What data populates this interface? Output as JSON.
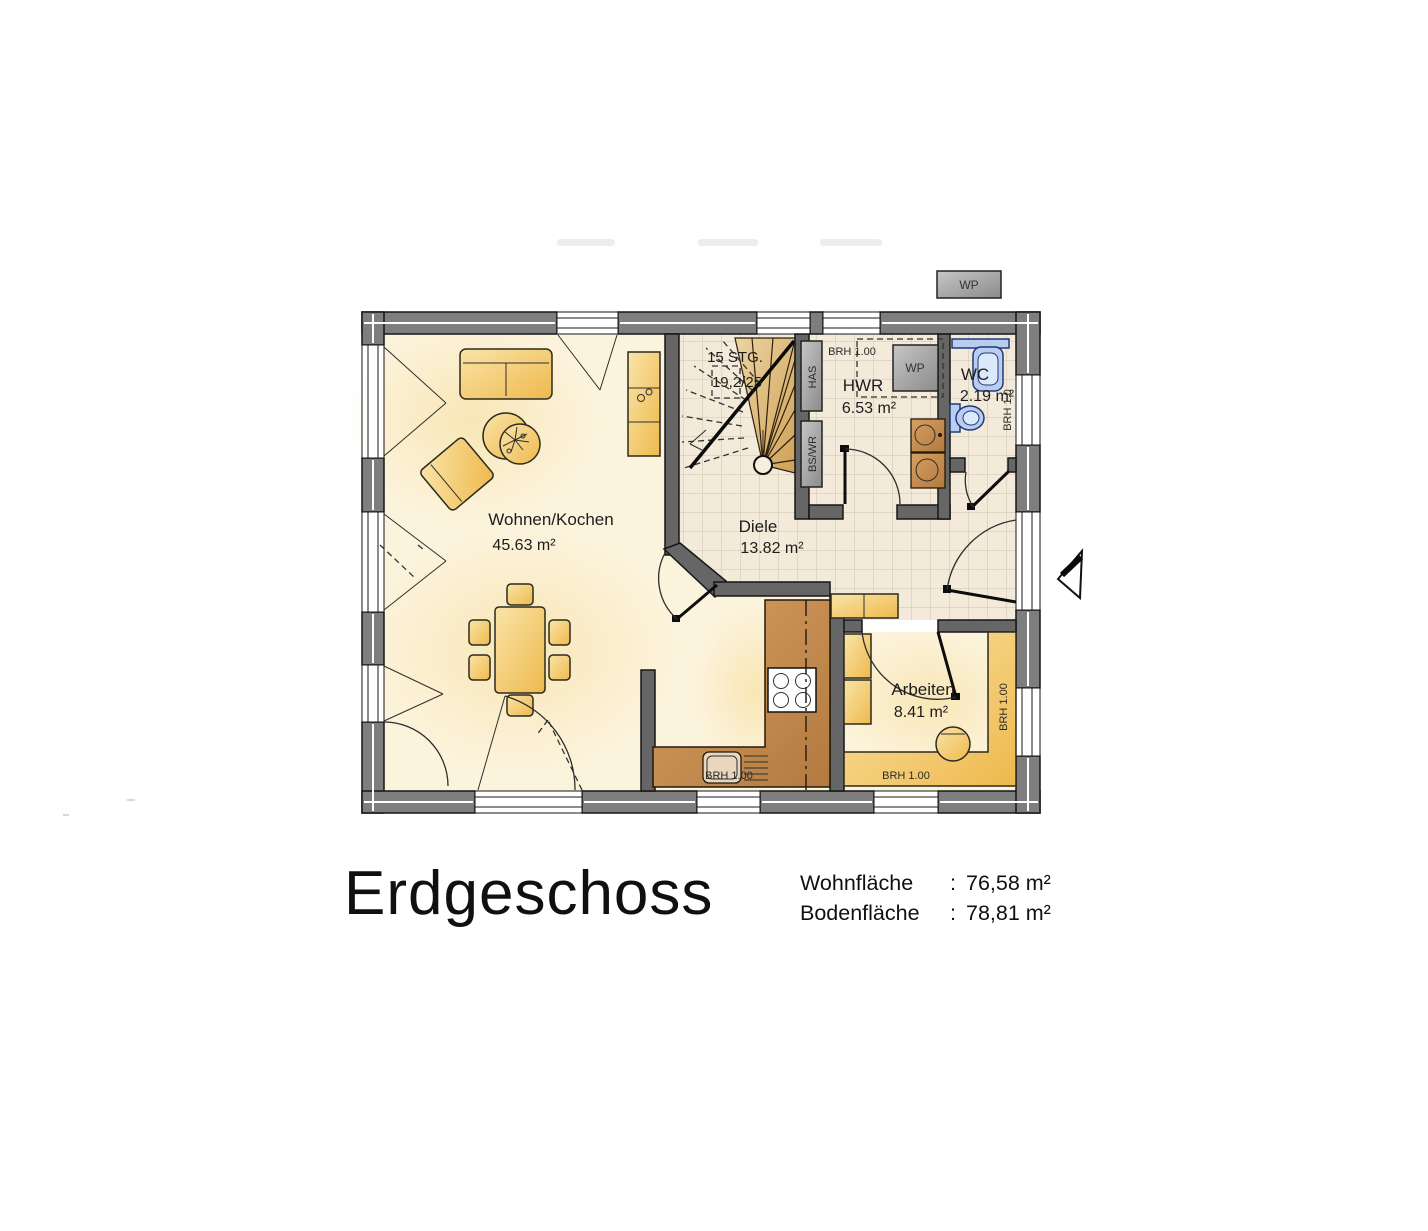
{
  "artifacts": {
    "wp_box": "WP"
  },
  "plan": {
    "rooms": [
      {
        "name": "Wohnen/Kochen",
        "area": "45.63 m²"
      },
      {
        "name": "Diele",
        "area": "13.82 m²"
      },
      {
        "name": "HWR",
        "area": "6.53 m²"
      },
      {
        "name": "WC",
        "area": "2.19 m²"
      },
      {
        "name": "Arbeiten",
        "area": "8.41 m²"
      }
    ],
    "stairs": {
      "count": "15 STG.",
      "ratio": "19,2/25"
    },
    "labels": {
      "wp": "WP",
      "has": "HAS",
      "bswr": "BS/WR",
      "brh": "BRH 1.00",
      "brh_short": "BRH 1.0"
    }
  },
  "footer": {
    "title": "Erdgeschoss",
    "rows": [
      {
        "label": "Wohnfläche",
        "sep": ":",
        "value": "76,58 m²"
      },
      {
        "label": "Bodenfläche",
        "sep": ":",
        "value": "78,81 m²"
      }
    ]
  },
  "colors": {
    "floor": "#fcf3dc",
    "wall-ext": "#7e7e7e",
    "wall-int": "#666666",
    "furniture": "#f0c05d",
    "counter": "#c3854a",
    "wood": "#d8b071",
    "fixture-blue": "#b9cdf0",
    "equipment-gray": "#a9a9a9",
    "ink": "#1d1d1d"
  }
}
